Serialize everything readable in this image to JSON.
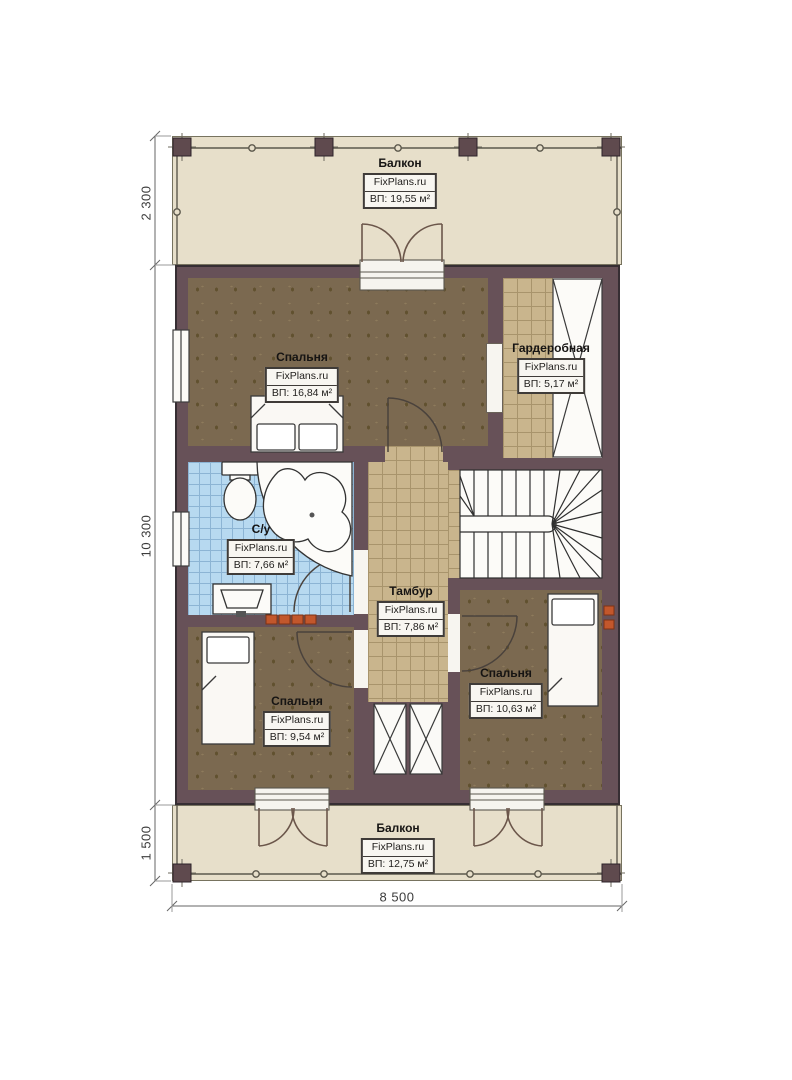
{
  "plan_title": "Floor plan with FixPlans.ru watermarks",
  "rooms": [
    {
      "id": "balcony-top",
      "name": "Балкон",
      "watermark": "FixPlans.ru",
      "area": "ВП: 19,55 м²"
    },
    {
      "id": "bedroom-top-left",
      "name": "Спальня",
      "watermark": "FixPlans.ru",
      "area": "ВП: 16,84 м²"
    },
    {
      "id": "wardrobe",
      "name": "Гардеробная",
      "watermark": "FixPlans.ru",
      "area": "ВП: 5,17 м²"
    },
    {
      "id": "bathroom",
      "name": "С/у",
      "watermark": "FixPlans.ru",
      "area": "ВП: 7,66 м²"
    },
    {
      "id": "vestibule",
      "name": "Тамбур",
      "watermark": "FixPlans.ru",
      "area": "ВП: 7,86 м²"
    },
    {
      "id": "bedroom-bottom-left",
      "name": "Спальня",
      "watermark": "FixPlans.ru",
      "area": "ВП: 9,54 м²"
    },
    {
      "id": "bedroom-bottom-right",
      "name": "Спальня",
      "watermark": "FixPlans.ru",
      "area": "ВП: 10,63 м²"
    },
    {
      "id": "balcony-bottom",
      "name": "Балкон",
      "watermark": "FixPlans.ru",
      "area": "ВП: 12,75 м²"
    }
  ],
  "dimensions": {
    "left_top": "2 300",
    "left_middle": "10 300",
    "left_bottom": "1 500",
    "bottom_width": "8 500"
  },
  "colors": {
    "wall": "#675158",
    "balcony_floor": "#e7dfca",
    "bedroom_floor": "#7b6950",
    "tile_tan": "#c9b58d",
    "tile_blue": "#b7d9f0",
    "radiator": "#c2572c"
  }
}
